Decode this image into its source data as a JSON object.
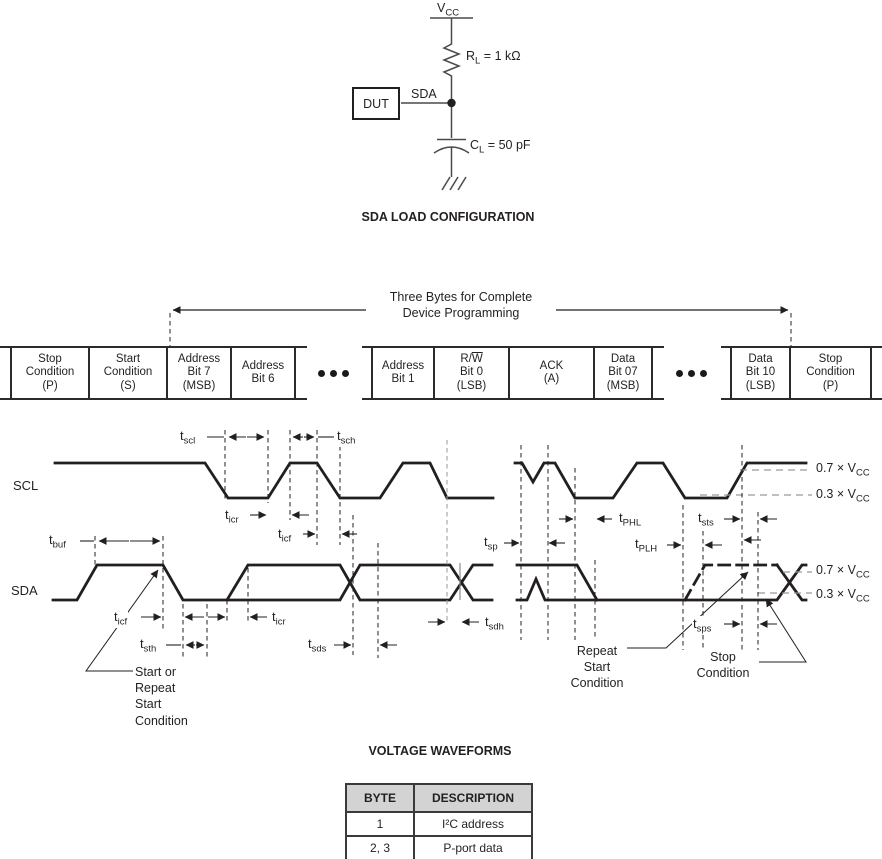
{
  "circuit": {
    "vcc": {
      "base": "V",
      "sub": "CC"
    },
    "rl": {
      "base": "R",
      "sub": "L",
      "suffix": " = 1 kΩ"
    },
    "sda": "SDA",
    "dut": "DUT",
    "cl": {
      "base": "C",
      "sub": "L",
      "suffix": " = 50 pF"
    },
    "title": "SDA LOAD CONFIGURATION"
  },
  "byte_sequence": {
    "arrow_label_line1": "Three Bytes for Complete",
    "arrow_label_line2": "Device Programming",
    "segments": [
      {
        "type": "edge",
        "x": 0,
        "w": 10
      },
      {
        "type": "cell",
        "x": 10,
        "w": 80,
        "lines": [
          "Stop",
          "Condition",
          "(P)"
        ]
      },
      {
        "type": "cell",
        "x": 90,
        "w": 78,
        "lines": [
          "Start",
          "Condition",
          "(S)"
        ]
      },
      {
        "type": "cell",
        "x": 168,
        "w": 64,
        "lines": [
          "Address",
          "Bit 7",
          "(MSB)"
        ]
      },
      {
        "type": "cell",
        "x": 232,
        "w": 64,
        "lines": [
          "Address",
          "Bit 6"
        ]
      },
      {
        "type": "gap",
        "x": 296,
        "w": 75
      },
      {
        "type": "cell",
        "x": 371,
        "w": 64,
        "lines": [
          "Address",
          "Bit 1"
        ]
      },
      {
        "type": "cell",
        "x": 435,
        "w": 75,
        "lines": [
          {
            "pre": "R/",
            "over": "W"
          },
          "Bit 0",
          "(LSB)"
        ]
      },
      {
        "type": "cell",
        "x": 510,
        "w": 85,
        "lines": [
          "ACK",
          "(A)"
        ]
      },
      {
        "type": "cell",
        "x": 595,
        "w": 58,
        "lines": [
          "Data",
          "Bit 07",
          "(MSB)"
        ]
      },
      {
        "type": "gap",
        "x": 653,
        "w": 77
      },
      {
        "type": "cell",
        "x": 730,
        "w": 61,
        "lines": [
          "Data",
          "Bit 10",
          "(LSB)"
        ]
      },
      {
        "type": "cell",
        "x": 791,
        "w": 81,
        "lines": [
          "Stop",
          "Condition",
          "(P)"
        ]
      },
      {
        "type": "edge",
        "x": 872,
        "w": 10
      }
    ]
  },
  "waveforms": {
    "scl_label": "SCL",
    "sda_label": "SDA",
    "title": "VOLTAGE WAVEFORMS",
    "ref_labels": [
      {
        "prefix": "0.7 × ",
        "base": "V",
        "sub": "CC",
        "x": 816,
        "y": 461
      },
      {
        "prefix": "0.3 × ",
        "base": "V",
        "sub": "CC",
        "x": 816,
        "y": 487
      },
      {
        "prefix": "0.7 × ",
        "base": "V",
        "sub": "CC",
        "x": 816,
        "y": 563
      },
      {
        "prefix": "0.3 × ",
        "base": "V",
        "sub": "CC",
        "x": 816,
        "y": 587
      }
    ],
    "timing_labels": [
      {
        "base": "t",
        "sub": "scl",
        "x": 179,
        "y": 428
      },
      {
        "base": "t",
        "sub": "sch",
        "x": 336,
        "y": 428
      },
      {
        "base": "t",
        "sub": "icr",
        "x": 224,
        "y": 507
      },
      {
        "base": "t",
        "sub": "icf",
        "x": 277,
        "y": 526
      },
      {
        "base": "t",
        "sub": "buf",
        "x": 48,
        "y": 532
      },
      {
        "base": "t",
        "sub": "icf",
        "x": 113,
        "y": 609
      },
      {
        "base": "t",
        "sub": "sth",
        "x": 139,
        "y": 636
      },
      {
        "base": "t",
        "sub": "icr",
        "x": 271,
        "y": 609
      },
      {
        "base": "t",
        "sub": "sds",
        "x": 307,
        "y": 636
      },
      {
        "base": "t",
        "sub": "sdh",
        "x": 484,
        "y": 614
      },
      {
        "base": "t",
        "sub": "sp",
        "x": 483,
        "y": 534
      },
      {
        "base": "t",
        "sub": "PHL",
        "x": 618,
        "y": 510
      },
      {
        "base": "t",
        "sub": "PLH",
        "x": 634,
        "y": 536
      },
      {
        "base": "t",
        "sub": "sts",
        "x": 697,
        "y": 510
      },
      {
        "base": "t",
        "sub": "sps",
        "x": 692,
        "y": 616
      }
    ],
    "annotations": [
      {
        "lines": [
          "Start or",
          "Repeat",
          "Start",
          "Condition"
        ],
        "x": 135,
        "y": 664,
        "align": "left"
      },
      {
        "lines": [
          "Repeat",
          "Start",
          "Condition"
        ],
        "x": 597,
        "y": 643,
        "align": "center"
      },
      {
        "lines": [
          "Stop",
          "Condition"
        ],
        "x": 723,
        "y": 649,
        "align": "center"
      }
    ]
  },
  "table": {
    "headers": [
      "BYTE",
      "DESCRIPTION"
    ],
    "rows": [
      [
        "1",
        "I²C address"
      ],
      [
        "2, 3",
        "P-port data"
      ]
    ]
  },
  "colors": {
    "line": "#231f20",
    "gray": "#999999",
    "table_header_bg": "#d3d3d3"
  }
}
